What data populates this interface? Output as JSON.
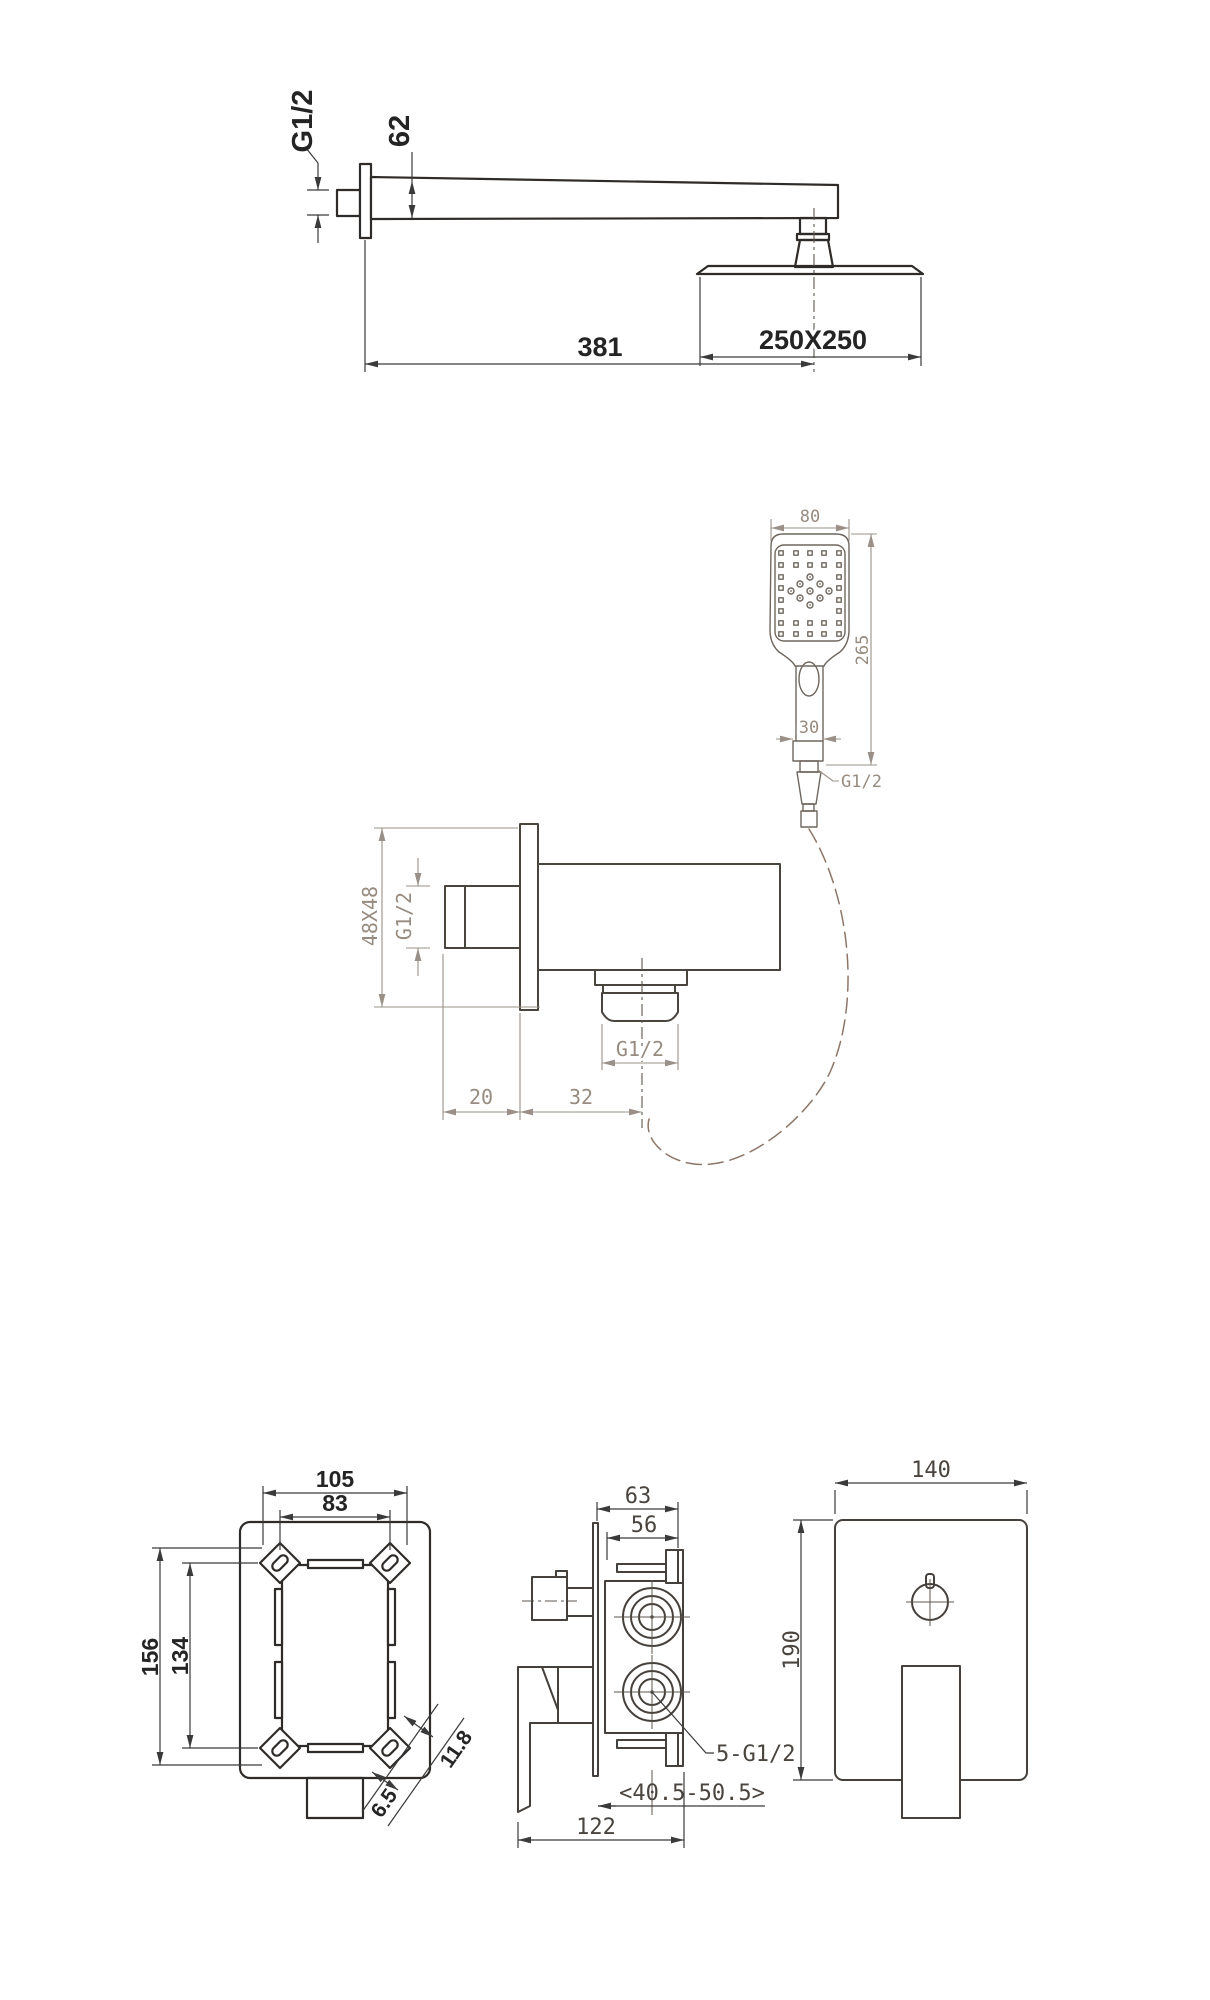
{
  "drawing": {
    "top_arm": {
      "thread": "G1/2",
      "arm_height": "62",
      "head_size": "250X250",
      "length": "381"
    },
    "hand_shower": {
      "head_width": "80",
      "length": "265",
      "handle_width": "30",
      "thread": "G1/2"
    },
    "outlet_elbow": {
      "plate_size": "48X48",
      "inlet_thread": "G1/2",
      "outlet_thread": "G1/2",
      "thread_depth": "20",
      "outlet_offset": "32"
    },
    "rough_in_box": {
      "lug_span_h": "105",
      "hole_span_h": "83",
      "lug_span_v": "156",
      "hole_span_v": "134",
      "slot_len": "11.8",
      "slot_w": "6.5"
    },
    "valve_side": {
      "depth_total": "63",
      "depth_body": "56",
      "height": "190",
      "ports": "5-G1/2",
      "wall_range": "<40.5-50.5>",
      "width_total": "122"
    },
    "valve_front": {
      "width": "140"
    }
  }
}
